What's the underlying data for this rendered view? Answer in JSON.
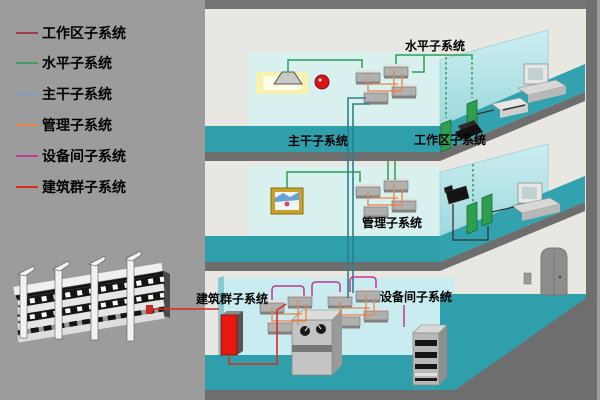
{
  "legend": {
    "items": [
      {
        "id": "work-area",
        "label": "工作区子系统",
        "color": "#a23a4e"
      },
      {
        "id": "horizontal",
        "label": "水平子系统",
        "color": "#3f9e68"
      },
      {
        "id": "backbone",
        "label": "主干子系统",
        "color": "#7e9cc4"
      },
      {
        "id": "management",
        "label": "管理子系统",
        "color": "#e8854a"
      },
      {
        "id": "equipment-room",
        "label": "设备间子系统",
        "color": "#c23a8e"
      },
      {
        "id": "campus",
        "label": "建筑群子系统",
        "color": "#e02a22"
      }
    ]
  },
  "diagram": {
    "labels": {
      "horizontal": "水平子系统",
      "backbone": "主干子系统",
      "work_area": "工作区子系统",
      "management": "管理子系统",
      "campus": "建筑群子系统",
      "equipment_room": "设备间子系统"
    },
    "colors": {
      "wire_green": "#2f9e58",
      "wire_backbone": "#2d7f8a",
      "wire_orange": "#e8854a",
      "wire_magenta": "#c23a8e",
      "wire_red": "#e02a22",
      "wire_dark": "#333333",
      "floor": "#2e9fab",
      "wall": "#d8f0ee",
      "glass_top": "#cdeef0",
      "glass_bottom": "#8fd2d8",
      "edge_gray": "#6e6e6e",
      "background": "#9c9c9c"
    }
  }
}
